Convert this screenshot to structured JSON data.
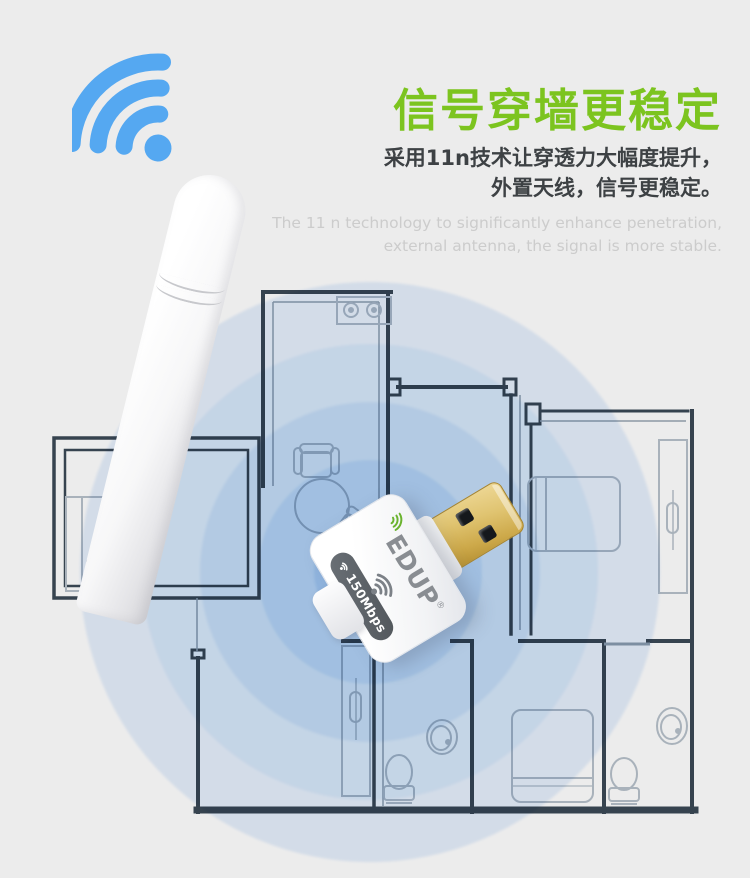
{
  "page": {
    "background": "#ececec"
  },
  "header": {
    "title": "信号穿墙更稳定",
    "title_color": "#7cc41f",
    "subtitle_line1": "采用11n技术让穿透力大幅度提升，",
    "subtitle_line2": "外置天线，信号更稳定。",
    "subtitle_en_line1": "The 11 n technology to significantly enhance penetration,",
    "subtitle_en_line2": "external antenna, the signal is more stable."
  },
  "product": {
    "brand": "EDUP",
    "reg_mark": "®",
    "speed_badge": "150Mbps",
    "brand_color": "#898d92",
    "brand_arcs_color": "#6ab32e",
    "badge_bg": "#5a5f64",
    "usb_color": "#d9b95f"
  },
  "diagram": {
    "type": "apartment-floor-plan-with-wifi-coverage",
    "signal_center_color": "#9cc3f0",
    "wall_color": "#36434f",
    "furniture_color": "#a9b2bb",
    "icons": [
      "wifi-signal-icon",
      "stove-icon",
      "desk",
      "office-chair",
      "armchair",
      "round-table",
      "dining-chair",
      "bed",
      "wardrobe",
      "toilet",
      "washbasin"
    ]
  }
}
